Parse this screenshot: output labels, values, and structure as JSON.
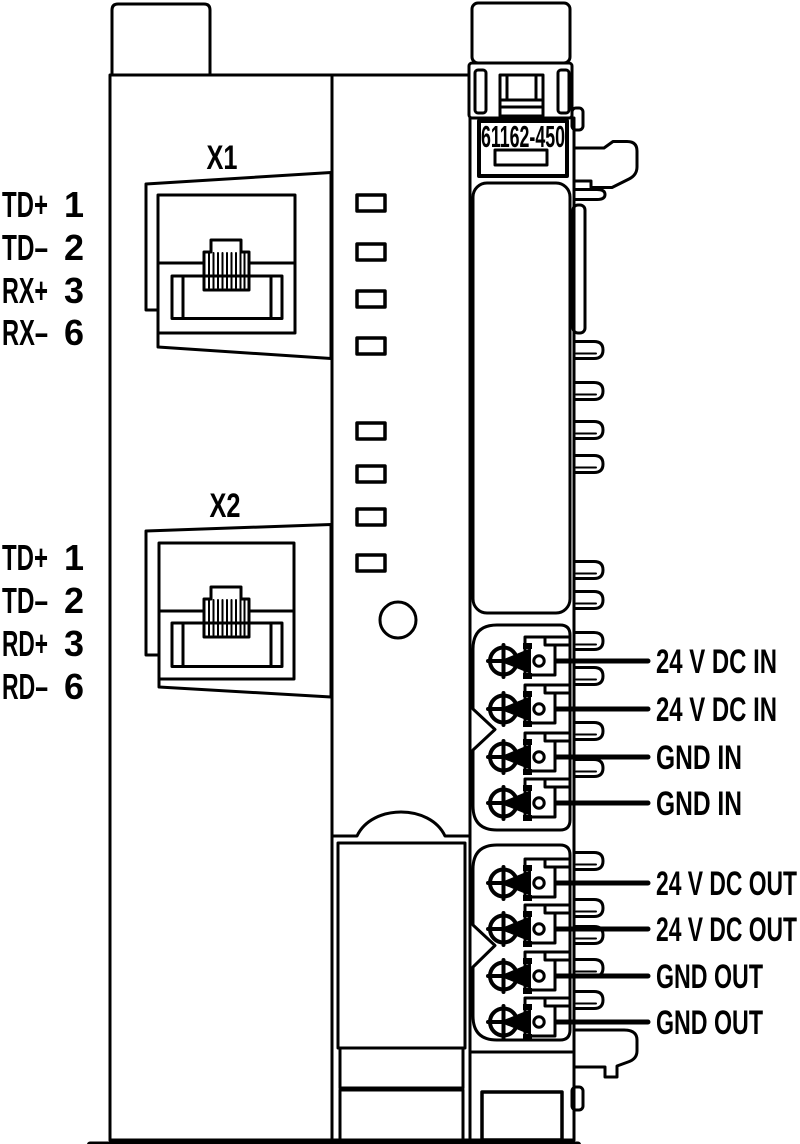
{
  "diagram": {
    "title": "fieldbus-coupler-connection-diagram",
    "module_order_number": "61162-450",
    "status_led_count": 8,
    "colors": {
      "line": "#000000",
      "background": "#ffffff"
    }
  },
  "ports": {
    "x1": {
      "label": "X1",
      "pins": [
        {
          "signal": "TD+",
          "pin": "1"
        },
        {
          "signal": "TD–",
          "pin": "2"
        },
        {
          "signal": "RX+",
          "pin": "3"
        },
        {
          "signal": "RX–",
          "pin": "6"
        }
      ]
    },
    "x2": {
      "label": "X2",
      "pins": [
        {
          "signal": "TD+",
          "pin": "1"
        },
        {
          "signal": "TD–",
          "pin": "2"
        },
        {
          "signal": "RD+",
          "pin": "3"
        },
        {
          "signal": "RD–",
          "pin": "6"
        }
      ]
    }
  },
  "power_terminals": {
    "in": [
      "24 V DC IN",
      "24 V DC IN",
      "GND IN",
      "GND IN"
    ],
    "out": [
      "24 V DC OUT",
      "24 V DC OUT",
      "GND OUT",
      "GND OUT"
    ]
  }
}
